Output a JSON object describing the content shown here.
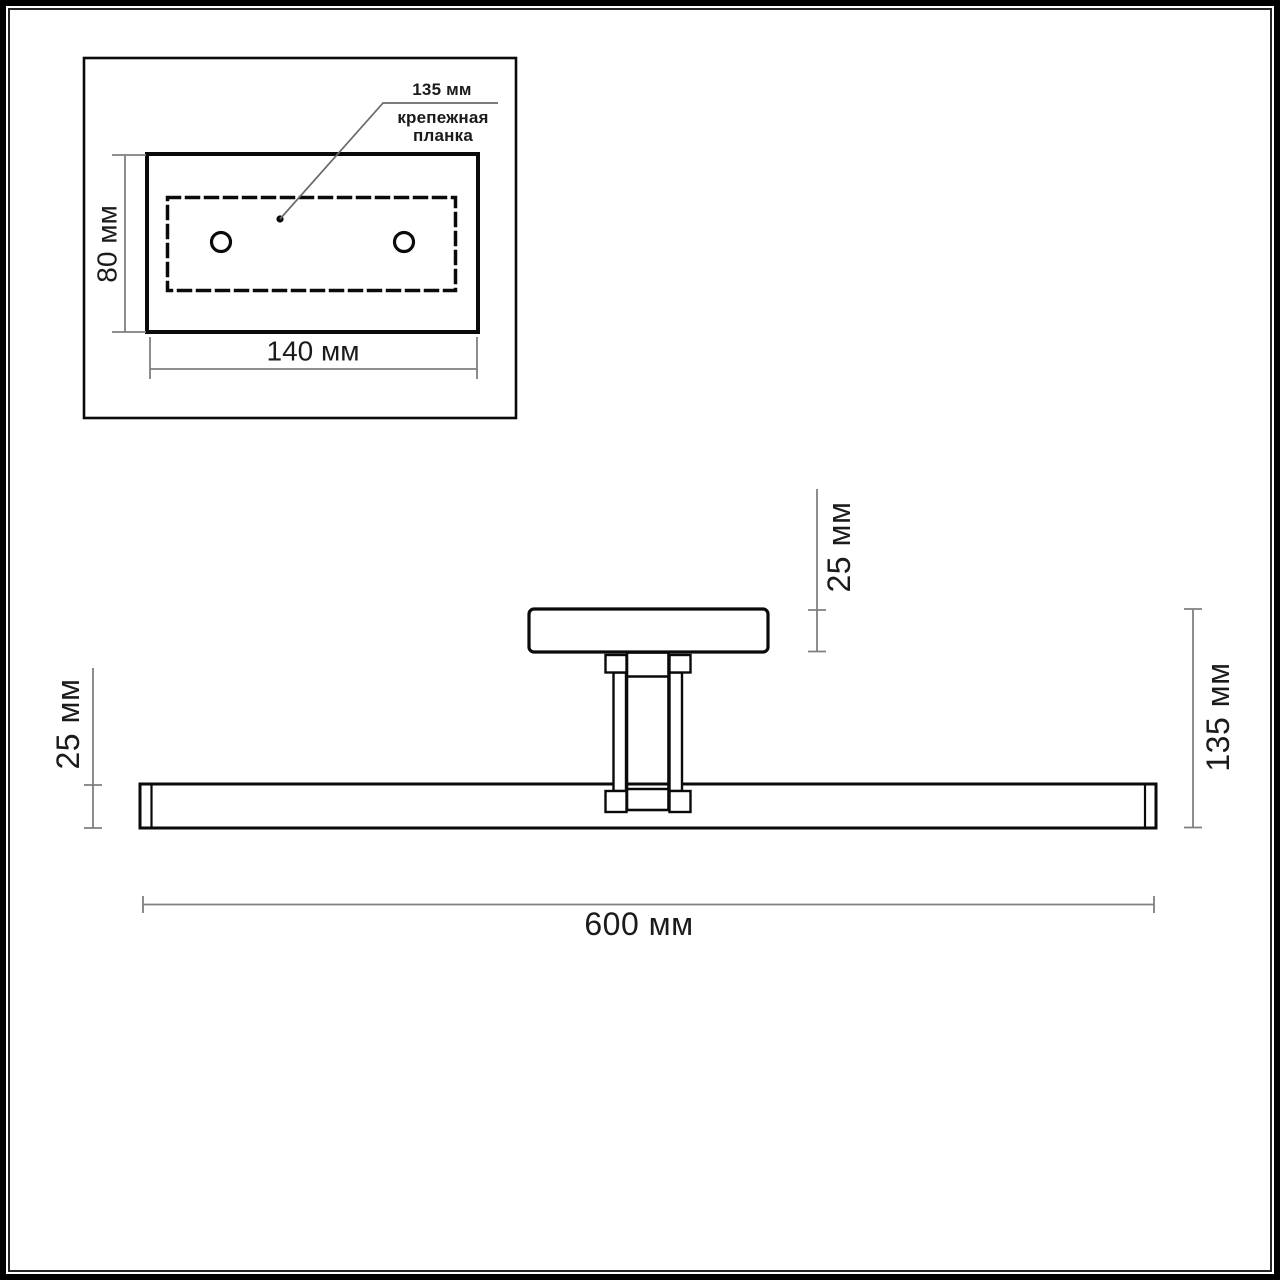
{
  "drawing_title": "wall-light-fixture-dimension-drawing",
  "units": "мм",
  "inset": {
    "annotation_value": "135 мм",
    "annotation_label": [
      "крепежная",
      "планка"
    ],
    "height_dim": "80 мм",
    "width_dim": "140 мм"
  },
  "main_view": {
    "bar_height_dim": "25 мм",
    "plate_height_dim": "25 мм",
    "total_height_dim": "135 мм",
    "length_dim": "600 мм"
  },
  "colors": {
    "background": "#ffffff",
    "line": "#0a0a0a",
    "dim_line": "#7f7f7f",
    "leader_line": "#6a6a6a",
    "text": "#1b1b1b"
  }
}
